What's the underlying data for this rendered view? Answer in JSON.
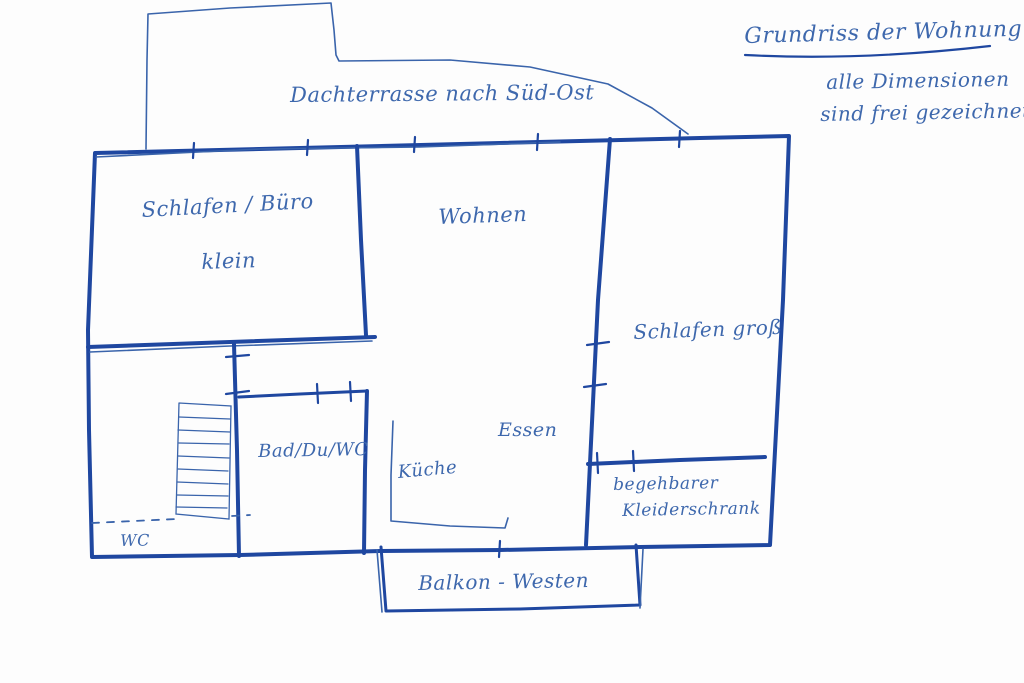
{
  "title_block": {
    "title": "Grundriss der Wohnung",
    "subtitle_line1": "alle Dimensionen",
    "subtitle_line2": "sind frei gezeichnet"
  },
  "labels": {
    "terrace": "Dachterrasse nach Süd-Ost",
    "bedroom_office": "Schlafen / Büro",
    "bedroom_office_size": "klein",
    "living_room": "Wohnen",
    "bedroom_large": "Schlafen groß",
    "bathroom": "Bad/Du/WC",
    "kitchen": "Küche",
    "dining": "Essen",
    "walkin_closet_line1": "begehbarer",
    "walkin_closet_line2": "Kleiderschrank",
    "wc": "WC",
    "balcony": "Balkon - Westen"
  },
  "colors": {
    "ink_wall": "#1f47a0",
    "ink_line": "#3a64ab",
    "ink_text": "#3e68ad",
    "background": "#fdfdfd"
  }
}
